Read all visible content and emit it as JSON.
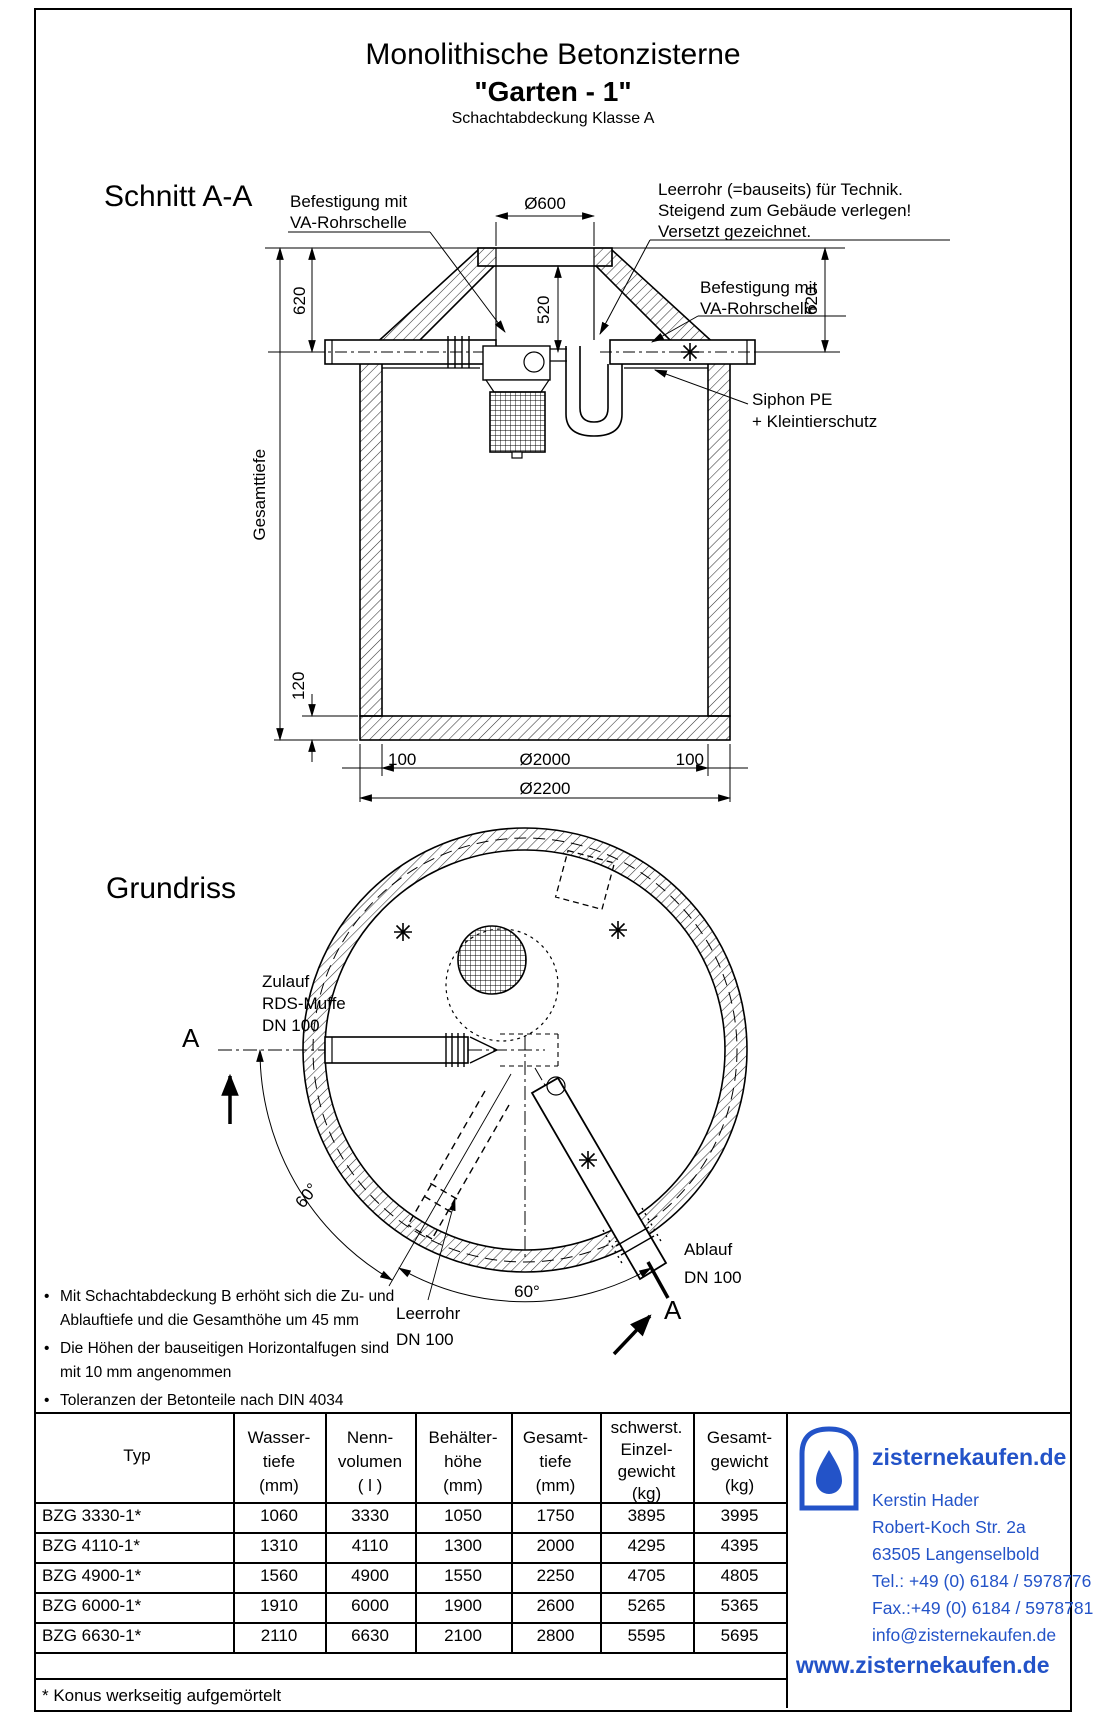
{
  "title": {
    "line1": "Monolithische Betonzisterne",
    "line2": "\"Garten - 1\"",
    "line3": "Schachtabdeckung Klasse A"
  },
  "schnitt": {
    "heading": "Schnitt A-A",
    "labels": {
      "befestigung_left": [
        "Befestigung mit",
        "VA-Rohrschelle"
      ],
      "leerrohr_note": [
        "Leerrohr (=bauseits) für Technik.",
        "Steigend zum Gebäude verlegen!",
        "Versetzt gezeichnet."
      ],
      "befestigung_right": [
        "Befestigung mit",
        "VA-Rohrschelle"
      ],
      "siphon": [
        "Siphon PE",
        "+ Kleintierschutz"
      ]
    },
    "dims": {
      "shaft_dia": "Ø600",
      "height_left": "620",
      "height_shaft": "520",
      "height_right": "620",
      "total_depth": "Gesamttiefe",
      "floor_thickness": "120",
      "wall_left": "100",
      "inner_dia": "Ø2000",
      "wall_right": "100",
      "outer_dia": "Ø2200"
    }
  },
  "grundriss": {
    "heading": "Grundriss",
    "labels": {
      "zulauf": [
        "Zulauf",
        "RDS-Muffe",
        "DN 100"
      ],
      "leerrohr": [
        "Leerrohr",
        "DN 100"
      ],
      "ablauf": [
        "Ablauf",
        "DN 100"
      ],
      "angle_left": "60°",
      "angle_bottom": "60°",
      "section_a_left": "A",
      "section_a_bottom": "A"
    }
  },
  "notes": {
    "bullet": "•",
    "items": [
      {
        "line1": "Mit Schachtabdeckung B erhöht sich die Zu- und",
        "line2": "Ablauftiefe und die Gesamthöhe um 45 mm"
      },
      {
        "line1": "Die Höhen der bauseitigen Horizontalfugen sind",
        "line2": "mit 10 mm angenommen"
      },
      {
        "line1": "Toleranzen der Betonteile nach DIN 4034",
        "line2": ""
      }
    ]
  },
  "table": {
    "headers": {
      "typ": "Typ",
      "wassertiefe": [
        "Wasser-",
        "tiefe",
        "(mm)"
      ],
      "nennvolumen": [
        "Nenn-",
        "volumen",
        "( l )"
      ],
      "behaelterhoehe": [
        "Behälter-",
        "höhe",
        "(mm)"
      ],
      "gesamttiefe": [
        "Gesamt-",
        "tiefe",
        "(mm)"
      ],
      "einzelgewicht": [
        "schwerst.",
        "Einzel-",
        "gewicht",
        "(kg)"
      ],
      "gesamtgewicht": [
        "Gesamt-",
        "gewicht",
        "(kg)"
      ]
    },
    "rows": [
      {
        "typ": "BZG 3330-1*",
        "wassertiefe": "1060",
        "nennvolumen": "3330",
        "behaelterhoehe": "1050",
        "gesamttiefe": "1750",
        "einzelgewicht": "3895",
        "gesamtgewicht": "3995"
      },
      {
        "typ": "BZG 4110-1*",
        "wassertiefe": "1310",
        "nennvolumen": "4110",
        "behaelterhoehe": "1300",
        "gesamttiefe": "2000",
        "einzelgewicht": "4295",
        "gesamtgewicht": "4395"
      },
      {
        "typ": "BZG 4900-1*",
        "wassertiefe": "1560",
        "nennvolumen": "4900",
        "behaelterhoehe": "1550",
        "gesamttiefe": "2250",
        "einzelgewicht": "4705",
        "gesamtgewicht": "4805"
      },
      {
        "typ": "BZG 6000-1*",
        "wassertiefe": "1910",
        "nennvolumen": "6000",
        "behaelterhoehe": "1900",
        "gesamttiefe": "2600",
        "einzelgewicht": "5265",
        "gesamtgewicht": "5365"
      },
      {
        "typ": "BZG 6630-1*",
        "wassertiefe": "2110",
        "nennvolumen": "6630",
        "behaelterhoehe": "2100",
        "gesamttiefe": "2800",
        "einzelgewicht": "5595",
        "gesamtgewicht": "5695"
      }
    ],
    "footnote": "* Konus werkseitig aufgemörtelt"
  },
  "company": {
    "name": "zisternekaufen.de",
    "contact": [
      "Kerstin Hader",
      "Robert-Koch Str. 2a",
      "63505 Langenselbold",
      "Tel.: +49 (0) 6184 / 5978776",
      "Fax.:+49 (0) 6184 / 5978781",
      "info@zisternekaufen.de"
    ],
    "website": "www.zisternekaufen.de",
    "brand_color": "#2353c8"
  }
}
